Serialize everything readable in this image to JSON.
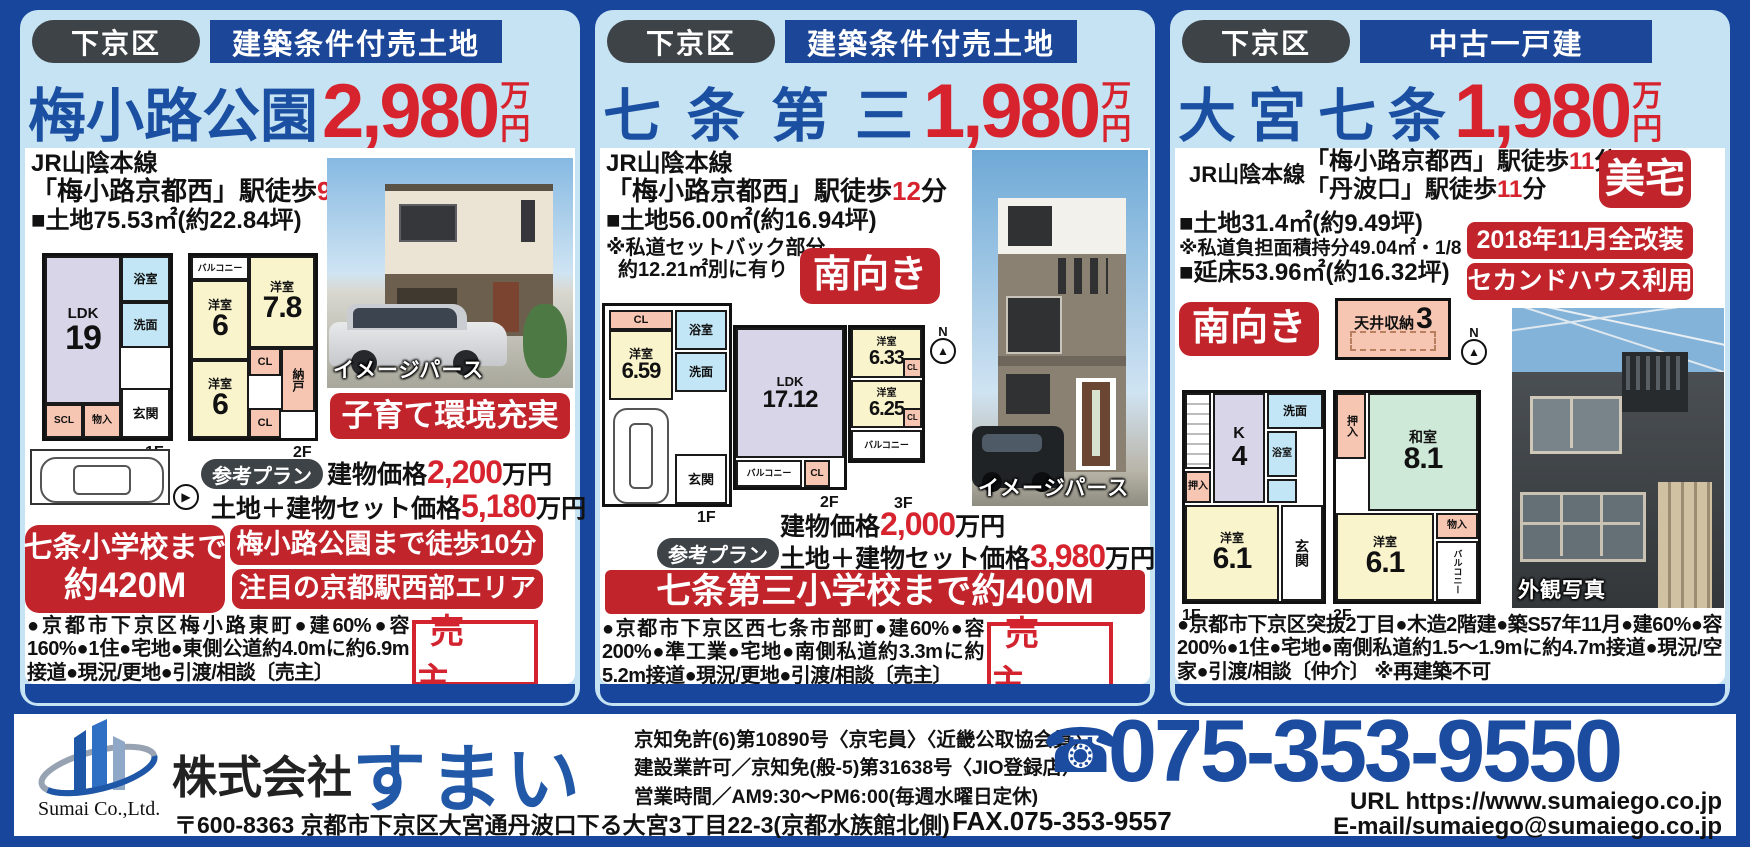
{
  "page": {
    "frame_color": "#17469c",
    "card_bg": "#c6e3f3",
    "accent_red": "#c2242c",
    "title_blue": "#1b4fa1"
  },
  "icons": {
    "north_arrow": "▲",
    "east_arrow": "▶",
    "phone": "☎"
  },
  "cards": [
    {
      "district": "下京区",
      "category": "建築条件付売土地",
      "name": "梅小路公園",
      "price": "2,980",
      "unit_top": "万",
      "unit_bottom": "円",
      "rail_line": "JR山陰本線",
      "access1_pre": "「梅小路京都西」駅徒歩",
      "access1_min": "9",
      "access1_post": "分",
      "land": "■土地75.53㎡(約22.84坪)",
      "plan1_label": "1F",
      "plan2_label": "2F",
      "compass_n": "N",
      "f1_rooms": {
        "ldk": "LDK",
        "ldk_size": "19",
        "bath": "浴室",
        "wash": "洗面",
        "scl": "SCL",
        "mono": "物入",
        "entrance": "玄関"
      },
      "f2_rooms": {
        "balcony": "バルコニー",
        "r1": "洋室",
        "r1_size": "7.8",
        "r2": "洋室",
        "r2_size": "6",
        "cl1": "CL",
        "closet": "納戸",
        "r3": "洋室",
        "r3_size": "6",
        "cl2": "CL"
      },
      "image_caption": "イメージパース",
      "feature_badge": "子育て環境充実",
      "plan_badge": "参考プラン",
      "price1_pre": "建物価格",
      "price1_num": "2,200",
      "price1_post": "万円",
      "price2_pre": "土地＋建物セット価格",
      "price2_num": "5,180",
      "price2_post": "万円",
      "school_badge_line1": "七条小学校まで",
      "school_badge_line2": "約420M",
      "badge_park": "梅小路公園まで徒歩10分",
      "badge_area": "注目の京都駅西部エリア",
      "description": "●京都市下京区梅小路東町●建60%●容160%●1住●宅地●東側公道約4.0mに約6.9m接道●現況/更地●引渡/相談〔売主〕",
      "seller": "売 主"
    },
    {
      "district": "下京区",
      "category": "建築条件付売土地",
      "name": "七条第三",
      "price": "1,980",
      "unit_top": "万",
      "unit_bottom": "円",
      "rail_line": "JR山陰本線",
      "access1_pre": "「梅小路京都西」駅徒歩",
      "access1_min": "12",
      "access1_post": "分",
      "land": "■土地56.00㎡(約16.94坪)",
      "note1": "※私道セットバック部分",
      "note2": "約12.21㎡別に有り",
      "direction_badge": "南向き",
      "plan1_label": "1F",
      "plan2_label": "2F",
      "plan3_label": "3F",
      "compass_n": "N",
      "f1_rooms": {
        "cl": "CL",
        "r1": "洋室",
        "r1_size": "6.59",
        "bath": "浴室",
        "wash": "洗面",
        "entrance": "玄関"
      },
      "f2_rooms": {
        "ldk": "LDK",
        "ldk_size": "17.12",
        "balcony": "バルコニー",
        "cl": "CL"
      },
      "f3_rooms": {
        "r1": "洋室",
        "r1_size": "6.33",
        "cl1": "CL",
        "r2": "洋室",
        "r2_size": "6.25",
        "cl2": "CL",
        "balcony": "バルコニー"
      },
      "image_caption": "イメージパース",
      "plan_badge": "参考プラン",
      "price1_pre": "建物価格",
      "price1_num": "2,000",
      "price1_post": "万円",
      "price2_pre": "土地＋建物セット価格",
      "price2_num": "3,980",
      "price2_post": "万円",
      "school_banner": "七条第三小学校まで約400M",
      "description": "●京都市下京区西七条市部町●建60%●容200%●準工業●宅地●南側私道約3.3mに約5.2m接道●現況/更地●引渡/相談〔売主〕",
      "seller": "売 主"
    },
    {
      "district": "下京区",
      "category": "中古一戸建",
      "name": "大宮七条",
      "price": "1,980",
      "unit_top": "万",
      "unit_bottom": "円",
      "rail_line": "JR山陰本線",
      "access1_pre": "「梅小路京都西」駅徒歩",
      "access1_min": "11",
      "access1_post": "分",
      "access2_pre": "「丹波口」駅徒歩",
      "access2_min": "11",
      "access2_post": "分",
      "nice_badge": "美宅",
      "land": "■土地31.4㎡(約9.49坪)",
      "note1": "※私道負担面積持分49.04㎡・1/8",
      "floor_area": "■延床53.96㎡(約16.32坪)",
      "badge_renovation": "2018年11月全改装",
      "badge_second": "セカンドハウス利用",
      "direction_badge": "南向き",
      "attic_label": "天井収納",
      "attic_size": "3",
      "compass_n": "N",
      "plan1_label": "1F",
      "plan2_label": "2F",
      "f1_rooms": {
        "k": "K",
        "k_size": "4",
        "wash": "洗面",
        "bath": "浴室",
        "oshiire": "押入",
        "r1": "洋室",
        "r1_size": "6.1",
        "entrance": "玄関"
      },
      "f2_rooms": {
        "oshiire": "押入",
        "washitsu": "和室",
        "washitsu_size": "8.1",
        "r1": "洋室",
        "r1_size": "6.1",
        "mono": "物入",
        "balcony": "バルコニー"
      },
      "photo_caption": "外観写真",
      "description": "●京都市下京区突抜2丁目●木造2階建●築S57年11月●建60%●容200%●1住●宅地●南側私道約1.5〜1.9mに約4.7m接道●現況/空家●引渡/相談〔仲介〕 ※再建築不可"
    }
  ],
  "footer": {
    "logo_caption": "Sumai Co.,Ltd.",
    "company_prefix": "株式会社",
    "company_name": "すまい",
    "license1": "京知免許(6)第10890号〈京宅員〉〈近畿公取協会員〉",
    "license2": "建設業許可／京知免(般-5)第31638号〈JIO登録店〉",
    "hours": "営業時間／AM9:30〜PM6:00(毎週水曜日定休)",
    "address": "〒600-8363 京都市下京区大宮通丹波口下る大宮3丁目22-3(京都水族館北側)",
    "phone": "075-353-9550",
    "fax": "FAX.075-353-9557",
    "url": "URL https://www.sumaiego.co.jp",
    "email": "E-mail/sumaiego@sumaiego.co.jp"
  }
}
